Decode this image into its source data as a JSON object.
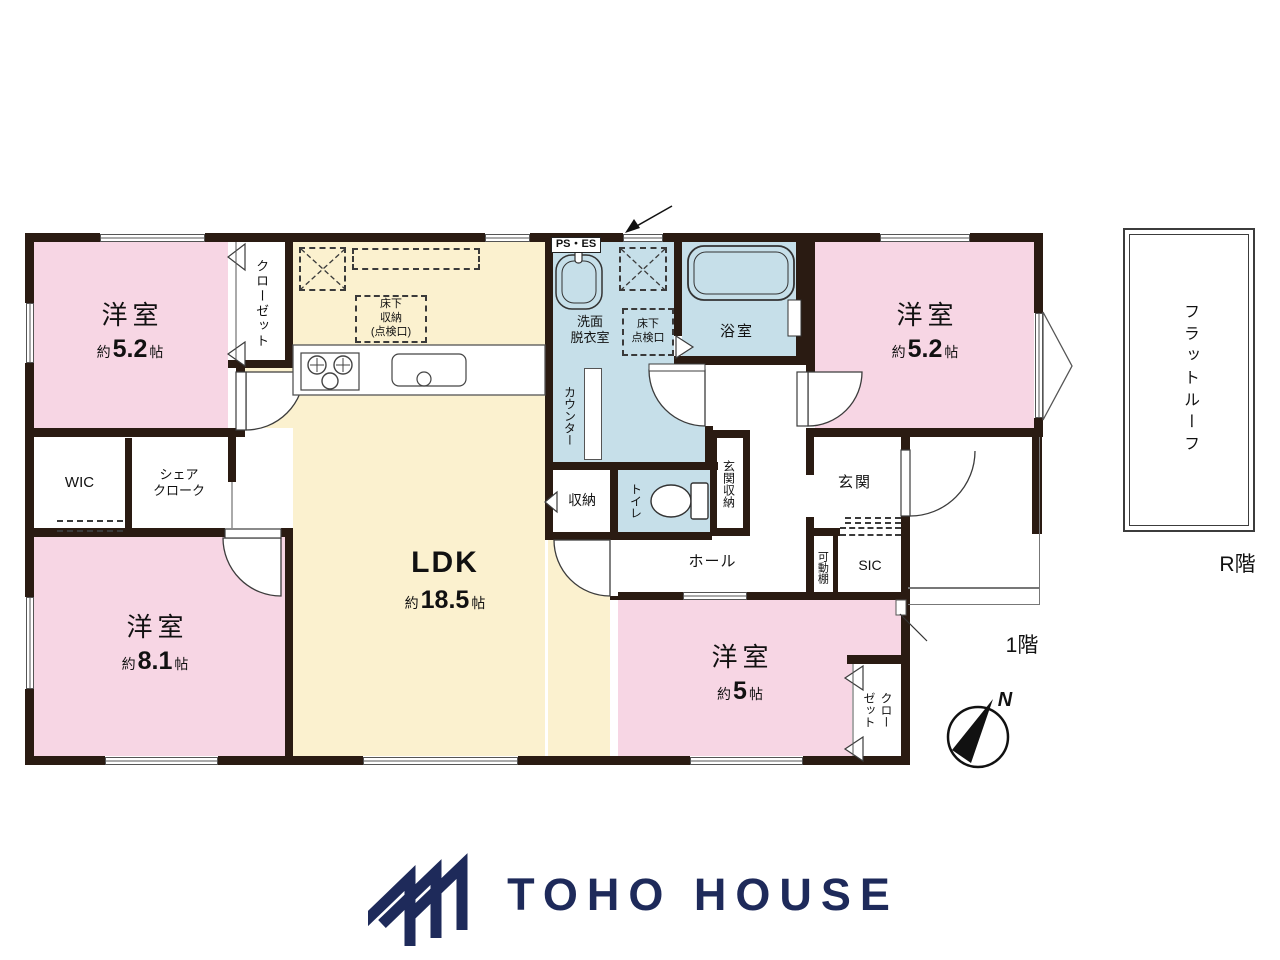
{
  "plan": {
    "floor_label": "1階",
    "roof_section_label": "R階",
    "compass_north_label": "N",
    "rooms": {
      "bedroom_top_left": {
        "name": "洋室",
        "approx": "約",
        "area": "5.2",
        "unit": "帖"
      },
      "bedroom_top_right": {
        "name": "洋室",
        "approx": "約",
        "area": "5.2",
        "unit": "帖"
      },
      "bedroom_bottom_left": {
        "name": "洋室",
        "approx": "約",
        "area": "8.1",
        "unit": "帖"
      },
      "bedroom_bottom_center": {
        "name": "洋室",
        "approx": "約",
        "area": "5",
        "unit": "帖"
      },
      "ldk": {
        "name": "LDK",
        "approx": "約",
        "area": "18.5",
        "unit": "帖"
      }
    },
    "labels": {
      "closet_top_left": "クローゼット",
      "wic": "WIC",
      "share_cloak": "シェア\nクローク",
      "ps_es": "PS・ES",
      "washroom": "洗面\n脱衣室",
      "underfloor_storage_kitchen": "床下\n収納\n(点検口)",
      "underfloor_hatch_washroom": "床下\n点検口",
      "counter": "カウンター",
      "bathroom": "浴室",
      "storage": "収納",
      "toilet": "トイレ",
      "entrance_storage": "玄関収納",
      "hall": "ホール",
      "entrance": "玄関",
      "movable_shelf": "可動棚",
      "sic": "SIC",
      "closet_bottom_right": "クロー\nゼット",
      "flat_roof": "フラットルーフ"
    }
  },
  "colors": {
    "bedroom_pink": "#f7d6e4",
    "ldk_cream": "#fbf1cf",
    "wet_area_blue": "#c6dfe9",
    "wall_dark": "#2a1b12",
    "logo_navy": "#1e2a5a"
  },
  "brand": {
    "name": "TOHO HOUSE"
  }
}
